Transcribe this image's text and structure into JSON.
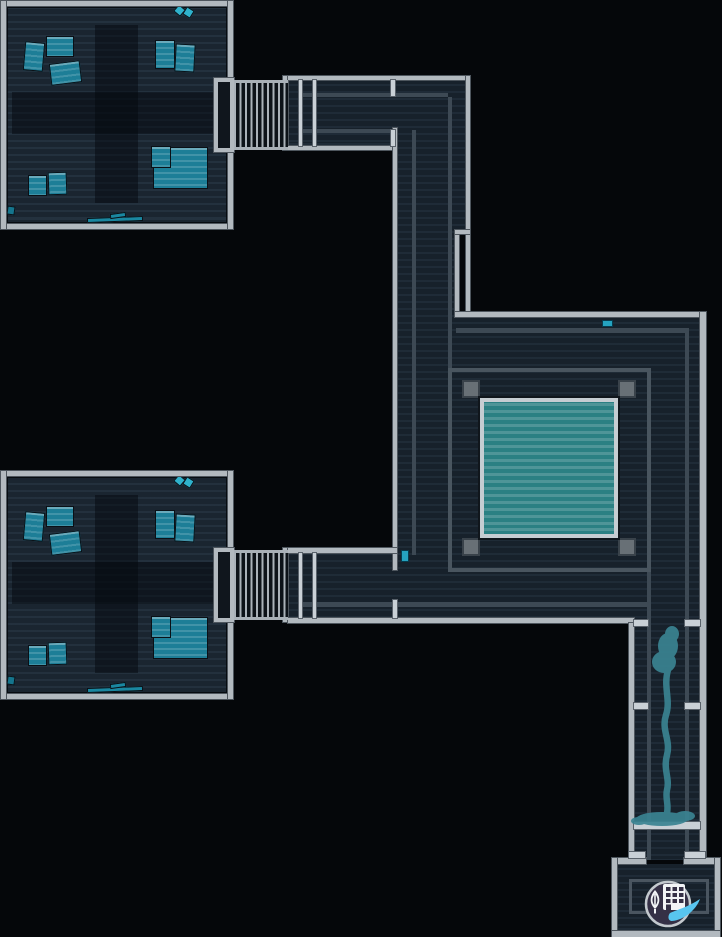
{
  "scene": {
    "width": 722,
    "height": 937,
    "background": "#05070a",
    "title": "station-map"
  },
  "palette": {
    "wall": "#b2b9bf",
    "wall_edge": "#4e565e",
    "door": "#c9d0d6",
    "corridor_floor": "#17212b",
    "room_floor": "#1a2530",
    "inner_line": "#3d4954",
    "furniture_teal": "#1d7e97",
    "furniture_small": "#15758d",
    "furniture_strip": "#1a87a0",
    "diamond": "#2fb2cc",
    "pickup": "#25a3c0",
    "pool_fill": "#2b8083",
    "pool_border": "#c6cdd2",
    "enclosure": "#49555f",
    "pillar": "#687076",
    "trail": "#3a8392",
    "icon_circle": "#353046",
    "icon_ring": "#c3c9ce",
    "icon_glyph": "#f2f4f6",
    "icon_swoosh": "#58c5ef"
  },
  "floors": [
    {
      "name": "room-top-floor",
      "rect": [
        6,
        6,
        222,
        218
      ],
      "kind": "room",
      "interactable": "true"
    },
    {
      "name": "room-bottom-floor",
      "rect": [
        6,
        476,
        222,
        218
      ],
      "kind": "room",
      "interactable": "true"
    },
    {
      "name": "corridor-top-horizontal",
      "rect": [
        283,
        80,
        187,
        66
      ],
      "kind": "corridor",
      "interactable": "true"
    },
    {
      "name": "corridor-vertical-left",
      "rect": [
        397,
        80,
        69,
        475
      ],
      "kind": "corridor",
      "interactable": "true"
    },
    {
      "name": "hall-around-pool",
      "rect": [
        397,
        315,
        309,
        303
      ],
      "kind": "corridor",
      "interactable": "true"
    },
    {
      "name": "corridor-bottom-horizontal",
      "rect": [
        288,
        553,
        346,
        65
      ],
      "kind": "corridor",
      "interactable": "true"
    },
    {
      "name": "corridor-right-vertical",
      "rect": [
        634,
        568,
        72,
        292
      ],
      "kind": "corridor",
      "interactable": "true"
    },
    {
      "name": "exit-room-floor",
      "rect": [
        617,
        864,
        98,
        67
      ],
      "kind": "corridor",
      "interactable": "true"
    }
  ],
  "black_patches": [
    {
      "name": "wall-gap",
      "rect": [
        459,
        234,
        7,
        80
      ]
    }
  ],
  "inner_lines": [
    [
      300,
      93,
      148,
      4
    ],
    [
      300,
      129,
      93,
      4
    ],
    [
      448,
      97,
      4,
      458
    ],
    [
      412,
      130,
      4,
      425
    ],
    [
      456,
      328,
      229,
      5
    ],
    [
      685,
      328,
      4,
      532
    ],
    [
      647,
      566,
      4,
      294
    ],
    [
      300,
      602,
      349,
      5
    ]
  ],
  "walls": [
    [
      1,
      1,
      232,
      5
    ],
    [
      1,
      224,
      232,
      5
    ],
    [
      1,
      1,
      5,
      228
    ],
    [
      228,
      1,
      5,
      228
    ],
    [
      1,
      471,
      232,
      5
    ],
    [
      1,
      694,
      232,
      5
    ],
    [
      1,
      471,
      5,
      228
    ],
    [
      228,
      471,
      5,
      228
    ],
    [
      283,
      76,
      5,
      74
    ],
    [
      283,
      548,
      5,
      74
    ],
    [
      288,
      76,
      182,
      4
    ],
    [
      288,
      146,
      105,
      4
    ],
    [
      393,
      128,
      4,
      442
    ],
    [
      466,
      76,
      4,
      239
    ],
    [
      455,
      232,
      4,
      83
    ],
    [
      455,
      230,
      15,
      4
    ],
    [
      455,
      312,
      251,
      5
    ],
    [
      700,
      312,
      6,
      548
    ],
    [
      288,
      548,
      109,
      5
    ],
    [
      288,
      618,
      346,
      5
    ],
    [
      629,
      623,
      5,
      237
    ],
    [
      612,
      858,
      34,
      6
    ],
    [
      684,
      858,
      36,
      6
    ],
    [
      612,
      858,
      5,
      79
    ],
    [
      715,
      858,
      5,
      79
    ],
    [
      612,
      931,
      108,
      6
    ]
  ],
  "airlocks": [
    {
      "name": "airlock-top",
      "bump": [
        214,
        78,
        20,
        74
      ],
      "bars": [
        234,
        80,
        54,
        70
      ]
    },
    {
      "name": "airlock-bottom",
      "bump": [
        214,
        548,
        20,
        74
      ],
      "bars": [
        234,
        550,
        54,
        70
      ]
    }
  ],
  "doors": [
    [
      299,
      80,
      3,
      66
    ],
    [
      313,
      80,
      3,
      66
    ],
    [
      391,
      80,
      4,
      16
    ],
    [
      391,
      130,
      4,
      16
    ],
    [
      299,
      553,
      3,
      65
    ],
    [
      313,
      553,
      3,
      65
    ],
    [
      393,
      600,
      4,
      18
    ],
    [
      634,
      620,
      14,
      6
    ],
    [
      685,
      620,
      15,
      6
    ],
    [
      634,
      703,
      14,
      6
    ],
    [
      685,
      703,
      15,
      6
    ],
    [
      634,
      822,
      66,
      7
    ],
    [
      629,
      852,
      16,
      6
    ],
    [
      685,
      852,
      20,
      6
    ]
  ],
  "rooms": [
    {
      "name": "room-top",
      "dy": 0
    },
    {
      "name": "room-bottom",
      "dy": 470
    }
  ],
  "room_decor": {
    "cross_vertical": [
      95,
      25,
      43,
      178
    ],
    "cross_horizontal": [
      12,
      92,
      210,
      42
    ],
    "furniture": [
      {
        "rect": [
          24,
          42,
          20,
          29
        ],
        "rot": 5,
        "variant": "desk"
      },
      {
        "rect": [
          46,
          36,
          28,
          21
        ],
        "rot": 0,
        "variant": "desk"
      },
      {
        "rect": [
          50,
          62,
          31,
          22
        ],
        "rot": -7,
        "variant": "desk"
      },
      {
        "rect": [
          155,
          40,
          20,
          29
        ],
        "rot": 0,
        "variant": "desk"
      },
      {
        "rect": [
          175,
          44,
          20,
          28
        ],
        "rot": 3,
        "variant": "desk"
      },
      {
        "rect": [
          153,
          147,
          55,
          42
        ],
        "rot": 0,
        "variant": "desk"
      },
      {
        "rect": [
          151,
          146,
          20,
          22
        ],
        "rot": 0,
        "variant": "desk"
      },
      {
        "rect": [
          28,
          175,
          19,
          21
        ],
        "rot": 0,
        "variant": "desk"
      },
      {
        "rect": [
          48,
          172,
          19,
          23
        ],
        "rot": -2,
        "variant": "desk"
      },
      {
        "rect": [
          7,
          206,
          8,
          9
        ],
        "rot": 8,
        "variant": "small"
      },
      {
        "rect": [
          87,
          217,
          56,
          5
        ],
        "rot": -2,
        "variant": "strip"
      },
      {
        "rect": [
          110,
          213,
          16,
          5
        ],
        "rot": -8,
        "variant": "strip"
      },
      {
        "rect": [
          175,
          6,
          9,
          9
        ],
        "rot": 40,
        "variant": "diamond"
      },
      {
        "rect": [
          184,
          8,
          9,
          9
        ],
        "rot": 32,
        "variant": "diamond"
      }
    ]
  },
  "pool_room": {
    "enclosure": [
      448,
      368,
      203,
      204
    ],
    "pillar_size": 18,
    "pillars": [
      [
        462,
        380
      ],
      [
        618,
        380
      ],
      [
        462,
        538
      ],
      [
        618,
        538
      ]
    ],
    "pool": [
      480,
      398,
      138,
      140
    ]
  },
  "pickups": [
    {
      "name": "pickup-item-hall",
      "rect": [
        602,
        320,
        11,
        7
      ]
    },
    {
      "name": "pickup-item-junction",
      "rect": [
        401,
        550,
        8,
        12
      ]
    }
  ],
  "trail": {
    "box": [
      622,
      612,
      88,
      236
    ],
    "color": "#3a8392",
    "opacity": 0.92
  },
  "objective_icon": {
    "box": [
      643,
      876,
      60,
      56
    ],
    "parts": [
      "building-icon",
      "leaf-icon",
      "swoosh-icon"
    ]
  },
  "exit_room": {
    "inner_rect": [
      629,
      879,
      80,
      35
    ]
  }
}
